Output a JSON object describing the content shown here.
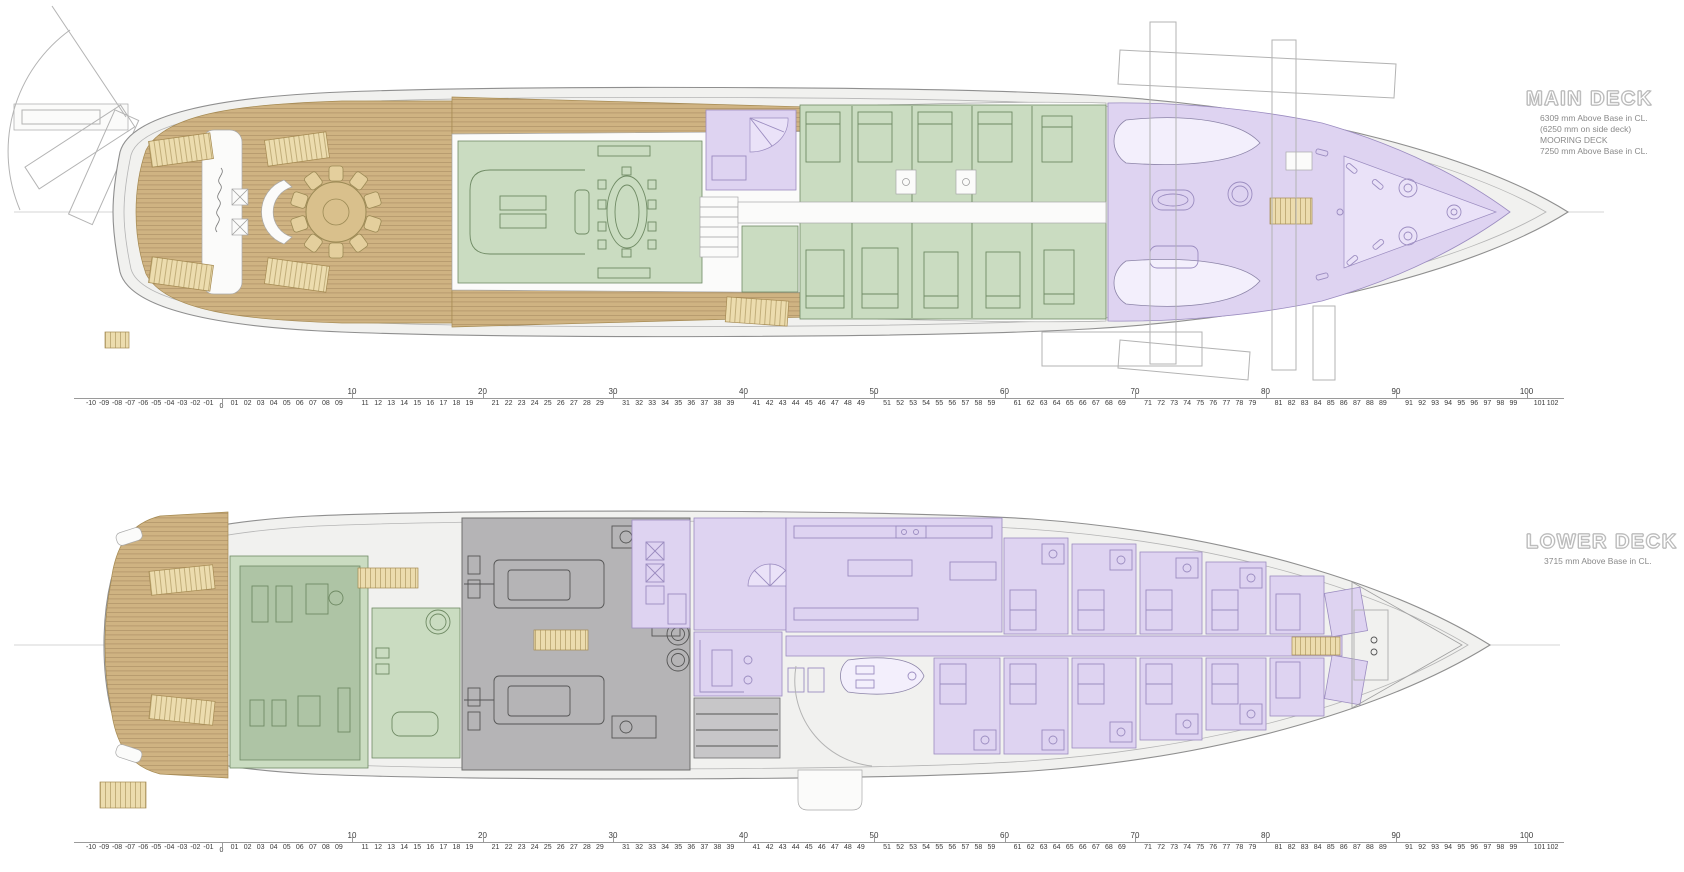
{
  "decks": [
    {
      "id": "main-deck",
      "title": "MAIN DECK",
      "subtitle_lines": [
        "6309 mm Above Base in CL.",
        "(6250 mm on side deck)",
        "MOORING DECK",
        "7250 mm Above Base in CL."
      ]
    },
    {
      "id": "lower-deck",
      "title": "LOWER DECK",
      "subtitle_lines": [
        "3715 mm Above Base in CL."
      ]
    }
  ],
  "frame_ruler": {
    "origin_label": "0",
    "major_labels": [
      "10",
      "20",
      "30",
      "40",
      "50",
      "60",
      "70",
      "80",
      "90",
      "100"
    ],
    "minor_labels": [
      "-10",
      "-09",
      "-08",
      "-07",
      "-06",
      "-05",
      "-04",
      "-03",
      "-02",
      "-01",
      "01",
      "02",
      "03",
      "04",
      "05",
      "06",
      "07",
      "08",
      "09",
      "11",
      "12",
      "13",
      "14",
      "15",
      "16",
      "17",
      "18",
      "19",
      "21",
      "22",
      "23",
      "24",
      "25",
      "26",
      "27",
      "28",
      "29",
      "31",
      "32",
      "33",
      "34",
      "35",
      "36",
      "37",
      "38",
      "39",
      "41",
      "42",
      "43",
      "44",
      "45",
      "46",
      "47",
      "48",
      "49",
      "51",
      "52",
      "53",
      "54",
      "55",
      "56",
      "57",
      "58",
      "59",
      "61",
      "62",
      "63",
      "64",
      "65",
      "66",
      "67",
      "68",
      "69",
      "71",
      "72",
      "73",
      "74",
      "75",
      "76",
      "77",
      "78",
      "79",
      "81",
      "82",
      "83",
      "84",
      "85",
      "86",
      "87",
      "88",
      "89",
      "91",
      "92",
      "93",
      "94",
      "95",
      "96",
      "97",
      "98",
      "99",
      "101",
      "102"
    ]
  },
  "palette": {
    "hull_fill": "#f1f1ef",
    "hull_line": "#8f8f8f",
    "inner_line": "#b5b5b5",
    "wood": "#cfb382",
    "wood_line": "#a58a52",
    "tread": "#ecdcae",
    "green": "#cadcc1",
    "green_dark": "#aec4a5",
    "green_line": "#6f8a64",
    "purple": "#ded3f1",
    "purple_light": "#eae2f8",
    "purple_line": "#9b8cc0",
    "gray": "#b5b4b6",
    "gray_light": "#c7c6c8",
    "gray_line": "#6e6e6e",
    "title_outline": "#b9b9b9",
    "subtitle": "#8a8a8a",
    "ruler_line": "#9a9a9a",
    "ruler_text": "#3a3a3a"
  }
}
